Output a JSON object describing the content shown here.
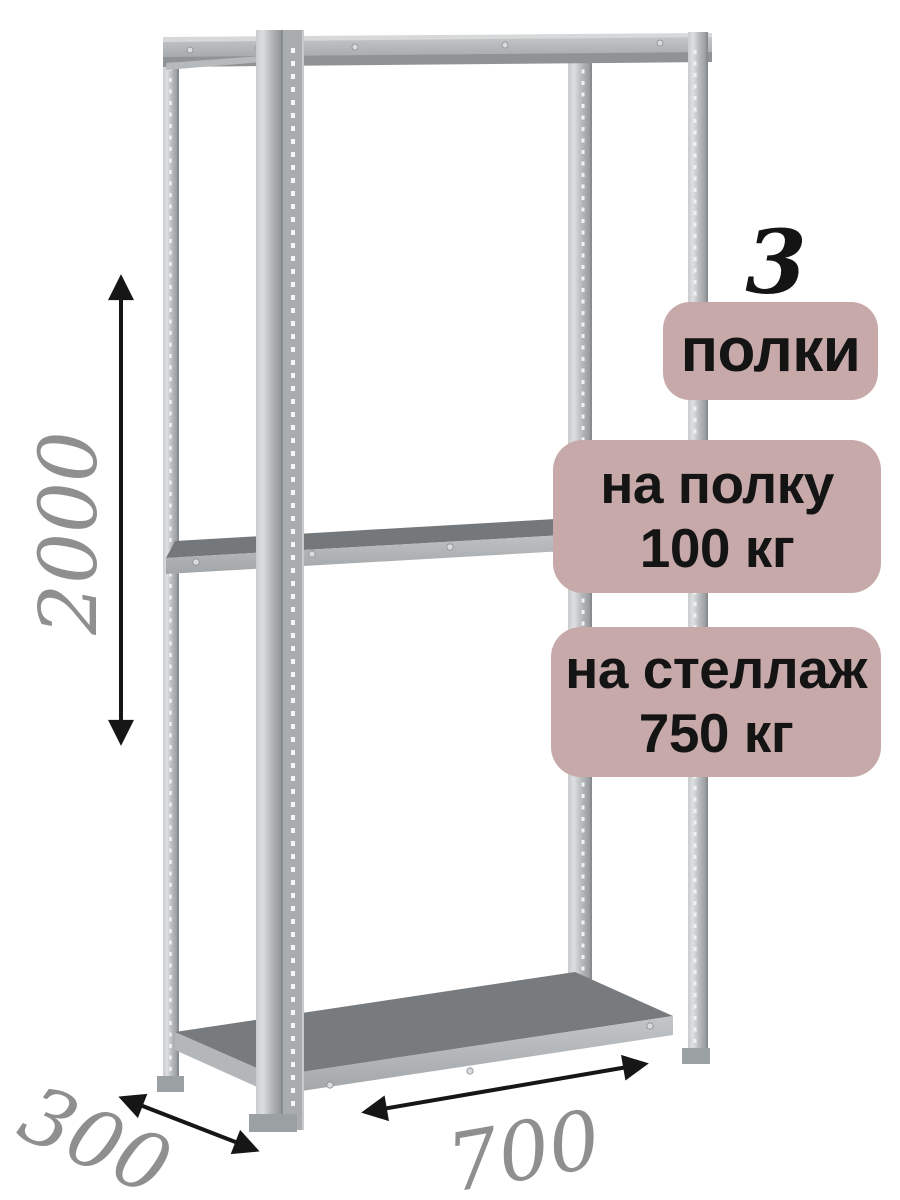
{
  "overlay": {
    "count": "3",
    "badges": [
      {
        "name": "shelves",
        "lines": [
          "полки"
        ]
      },
      {
        "name": "load-per-shelf",
        "lines": [
          "на полку",
          "100 кг"
        ]
      },
      {
        "name": "load-per-rack",
        "lines": [
          "на стеллаж",
          "750 кг"
        ]
      }
    ]
  },
  "dimensions": {
    "height": "2000",
    "depth": "300",
    "width": "700"
  },
  "colors": {
    "badge_bg": "#c6a9a8",
    "text_dark": "#141414",
    "dimension_text": "#8f8f8f",
    "arrow": "#161616",
    "metal_light": "#dddfe0",
    "metal_mid": "#b9bcbe",
    "metal_dark": "#8f9395",
    "shelf_top": "#75797c"
  }
}
